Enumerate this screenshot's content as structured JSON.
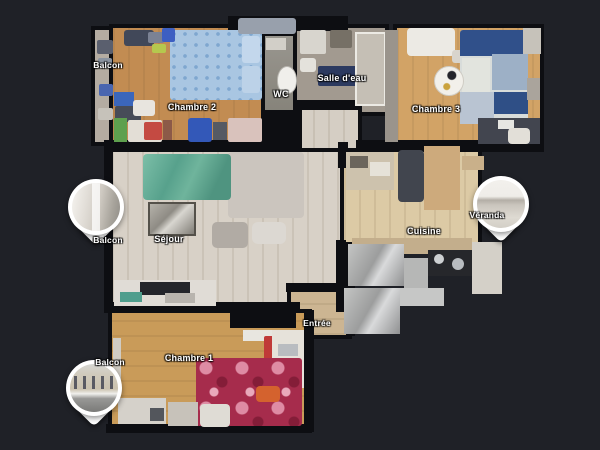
{
  "scene": {
    "type": "apartment-floorplan-top-view",
    "background_color": "#1f2127",
    "wall_color": "#0d0e12"
  },
  "floorplan": {
    "rooms": [
      {
        "id": "balcon-haut",
        "label": "Balcon"
      },
      {
        "id": "chambre-2",
        "label": "Chambre 2"
      },
      {
        "id": "wc",
        "label": "WC"
      },
      {
        "id": "salle-deau",
        "label": "Salle d'eau"
      },
      {
        "id": "chambre-3",
        "label": "Chambre 3"
      },
      {
        "id": "sejour",
        "label": "Séjour"
      },
      {
        "id": "cuisine",
        "label": "Cuisine"
      },
      {
        "id": "entree",
        "label": "Entrée"
      },
      {
        "id": "chambre-1",
        "label": "Chambre 1"
      }
    ],
    "pins": [
      {
        "id": "pin-balcon-sejour",
        "label": "Balcon"
      },
      {
        "id": "pin-veranda",
        "label": "Véranda"
      },
      {
        "id": "pin-balcon-chambre-1",
        "label": "Balcon"
      }
    ]
  },
  "palette": {
    "wood_chambre2": "#c28c52",
    "wood_chambre3": "#d2a366",
    "wood_chambre1": "#c99b59",
    "wood_sejour": "#d8d1c7",
    "wood_cuisine": "#dccaa5",
    "tile_wc": "#8e8b86",
    "tile_salle_deau": "#a29a90",
    "sofa_teal": "#57a18c",
    "bed_blue": "#a9c6e2",
    "bed_red": "#a62c4c",
    "bed_plaid_navy": "#30508a",
    "mat_navy": "#2c3a60"
  }
}
